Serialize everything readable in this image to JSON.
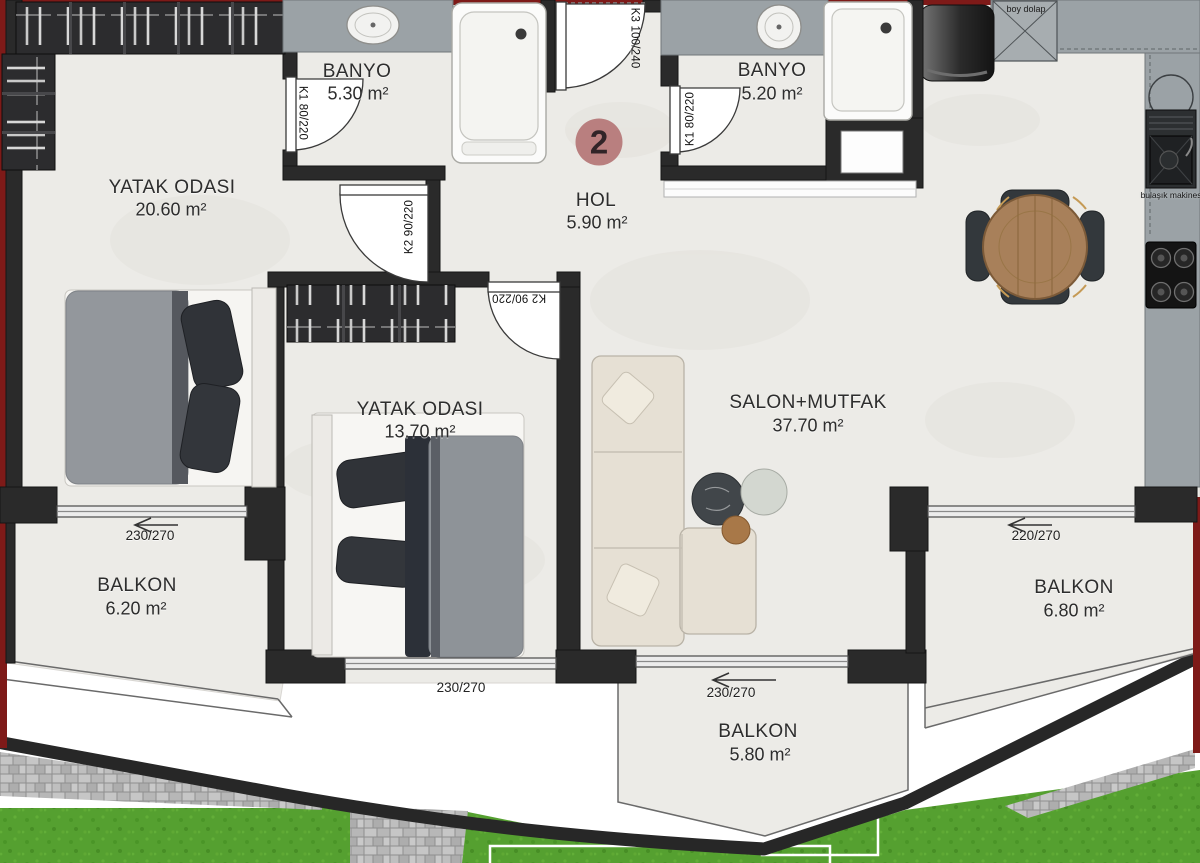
{
  "unit": {
    "number": "2"
  },
  "rooms": {
    "bedroom1": {
      "name": "YATAK ODASI",
      "area": "20.60 m²"
    },
    "banyo1": {
      "name": "BANYO",
      "area": "5.30 m²"
    },
    "hol": {
      "name": "HOL",
      "area": "5.90 m²"
    },
    "banyo2": {
      "name": "BANYO",
      "area": "5.20 m²"
    },
    "bedroom2": {
      "name": "YATAK ODASI",
      "area": "13.70 m²"
    },
    "salon": {
      "name": "SALON+MUTFAK",
      "area": "37.70 m²"
    },
    "balkon_left": {
      "name": "BALKON",
      "area": "6.20 m²"
    },
    "balkon_right": {
      "name": "BALKON",
      "area": "6.80 m²"
    },
    "balkon_bottom": {
      "name": "BALKON",
      "area": "5.80 m²"
    }
  },
  "doors": {
    "k1_banyo1": "K1 80/220",
    "k1_banyo2": "K1 80/220",
    "k2_bedroom1": "K2 90/220",
    "k2_bedroom2": "K2 90/220",
    "k3_entrance": "K3 100/240"
  },
  "windows": {
    "bedroom1_balkon": "230/270",
    "bedroom2_balkon": "230/270",
    "salon_balkon": "230/270",
    "salon_right": "220/270"
  },
  "kitchen": {
    "tall_cabinet": "boy dolap",
    "dishwasher": "bulaşık makinesi"
  },
  "colors": {
    "badge": "#b97f7f",
    "accent_red": "#7e1a18",
    "wall": "#2a2a2a",
    "floor": "#ecebe7",
    "counter": "#9ba2a6",
    "grass": "#55a030",
    "stone": "#bdbdbd"
  }
}
